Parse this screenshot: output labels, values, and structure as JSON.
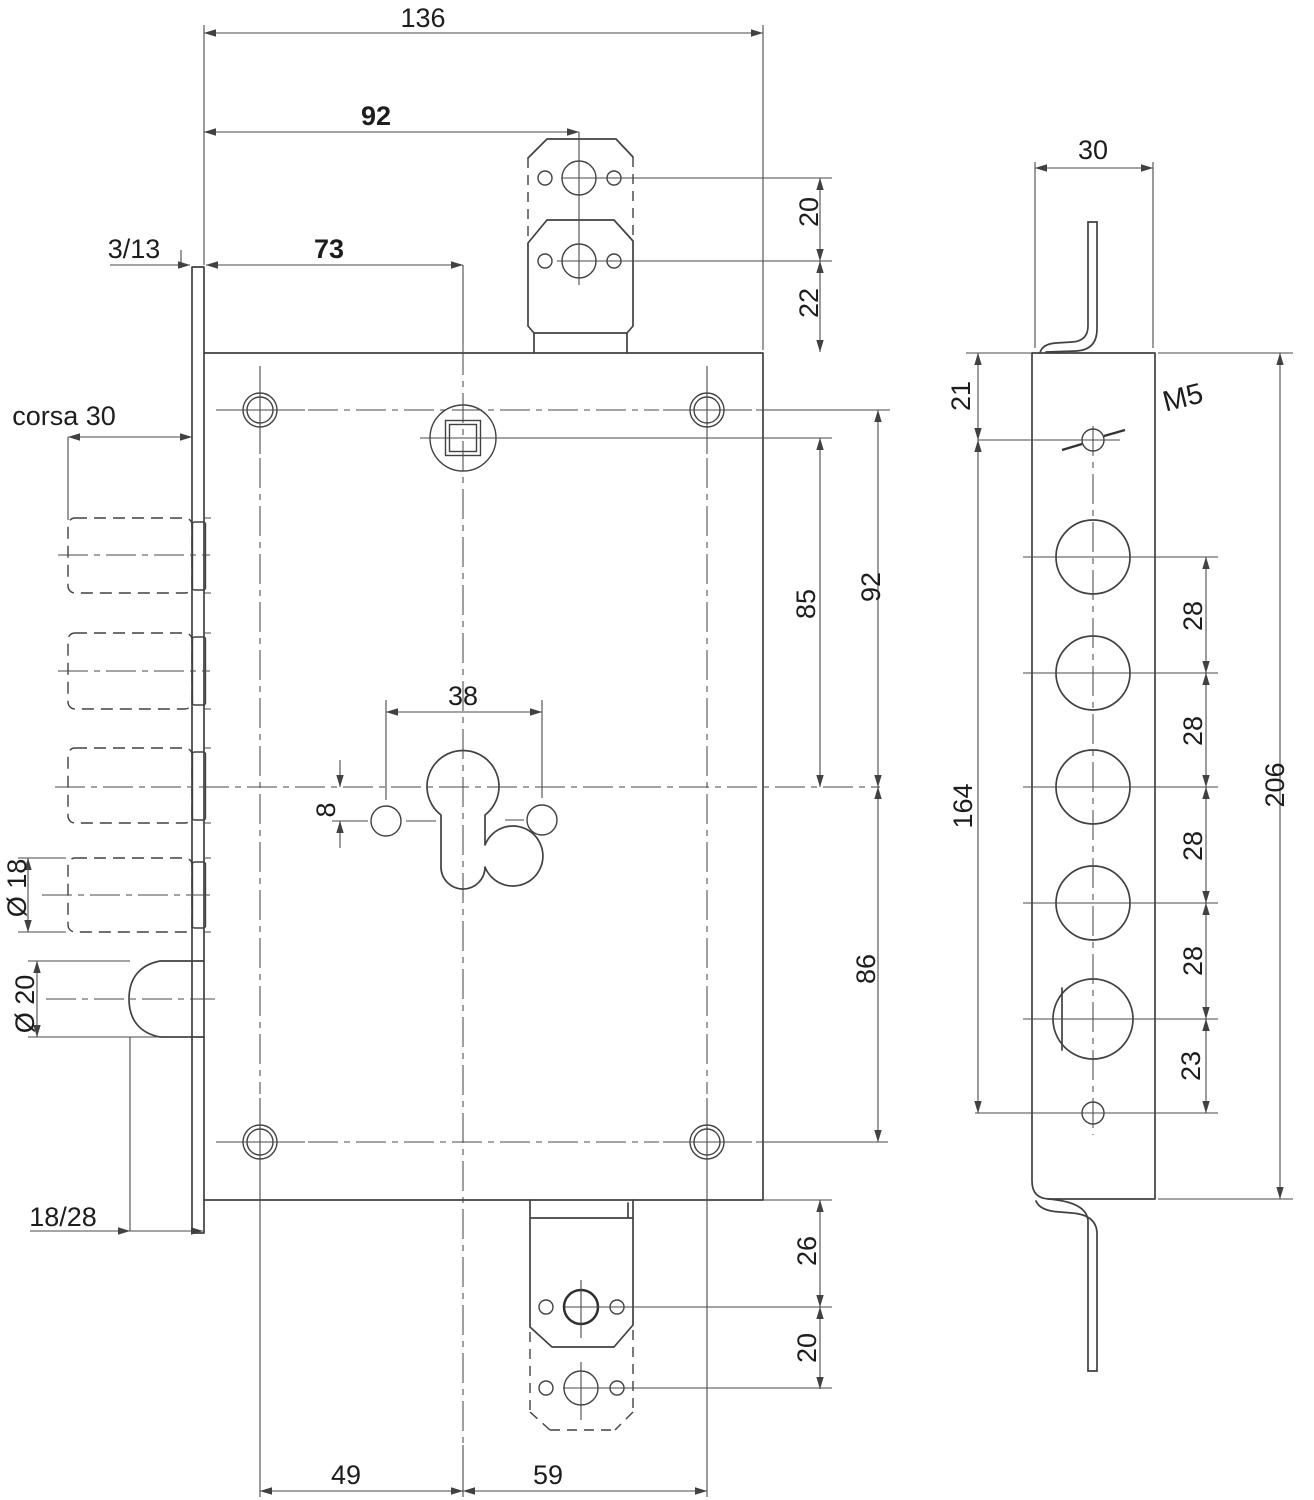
{
  "drawing_title": "Lock dimensional drawing",
  "front": {
    "total_width": "136",
    "striker_center_backset": "92",
    "cylinder_backset": "73",
    "faceplate_offset": "3/13",
    "stroke_label": "corsa 30",
    "striker_top_hole_pitch": "20",
    "striker_top_to_body": "22",
    "follower_to_cylinder": "85",
    "hole_to_cylinder_right": "92",
    "cylinder_to_hole_bottom": "86",
    "cylinder_screw_pitch": "38",
    "screw_offset": "8",
    "aux_bolt_dia": "Ø 18",
    "latch_dia": "Ø 20",
    "latch_backset": "18/28",
    "body_to_striker_hole": "26",
    "striker_bottom_hole_pitch": "20",
    "hole_to_center_left": "49",
    "center_to_hole_right": "59"
  },
  "side": {
    "plate_width": "30",
    "top_to_m5": "21",
    "thread_label": "M5",
    "m5_to_bottom_hole": "164",
    "total_height": "206",
    "pitch_1": "28",
    "pitch_2": "28",
    "pitch_3": "28",
    "pitch_4": "28",
    "last_pitch": "23"
  }
}
